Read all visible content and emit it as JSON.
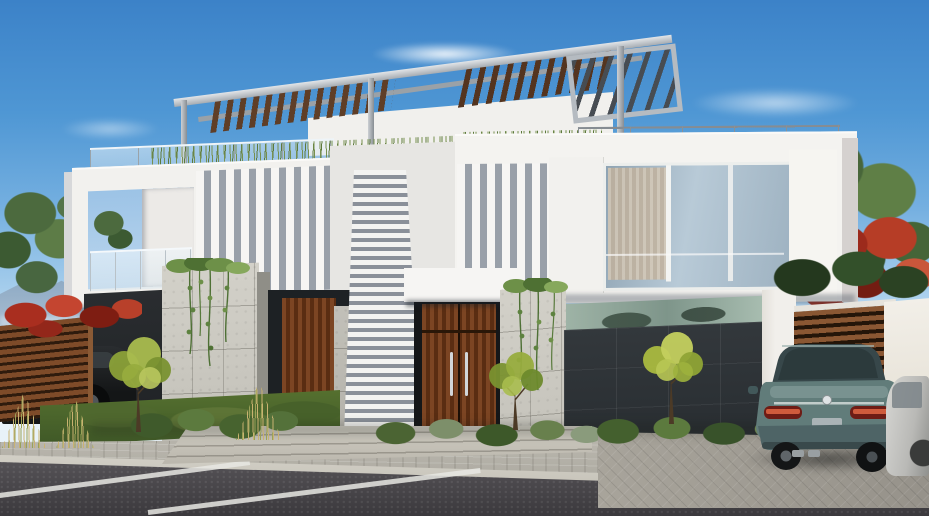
{
  "scene": {
    "type": "3d-architectural-exterior-render",
    "description": "Street-level daytime render of a modern two-storey white duplex villa with a rooftop steel-and-timber pergola, vertical shading fins, full-height louver screen, concrete and dark panelled ground-floor walls, timber entry doors, a timber slat gate with a teal sedan parked on the driveway, landscaped frontage and an asphalt street with white parking markings in the foreground.",
    "time_of_day": "day",
    "weather": "clear"
  },
  "palette": {
    "sky_top": "#3c82c8",
    "sky_horizon": "#e2eff8",
    "cloud": "#ffffff",
    "mountain": "#8ba6c0",
    "white_wall_sunlit": "#f6f5f2",
    "white_wall_shaded": "#d7d8da",
    "fin_gap_shadow": "#99a0a9",
    "concrete": "#cbc9c1",
    "dark_panel": "#2e3337",
    "timber_door": "#7c4523",
    "timber_slat_gap": "#241509",
    "pergola_steel": "#b5bbc1",
    "pergola_timber": "#5f3e27",
    "glass_window": "#9eb2c1",
    "curtain": "#d8c9b4",
    "glass_railing": "#dceaf3",
    "foliage_green": "#5d7c47",
    "foliage_yellow_green": "#a9bc4e",
    "flower_red": "#b23a24",
    "lawn": "#5d7436",
    "grass_tan": "#c9b271",
    "sidewalk_paver": "#b8b5ac",
    "driveway_paver": "#a5a198",
    "asphalt": "#4a484c",
    "road_marking": "#e8e7e3",
    "car_teal": "#617c7a",
    "car_glass": "#37474a",
    "taillight_red": "#cf5b3c",
    "car_dark": "#1d2022",
    "car_silver": "#cbcbc8"
  },
  "objects": {
    "sky": {
      "label": "Clear blue sky"
    },
    "mountains": {
      "label": "Distant hazy mountains"
    },
    "villa": {
      "label": "Modern white duplex villa"
    },
    "pergola": {
      "label": "Rooftop steel and timber pergola"
    },
    "roof_terrace": {
      "label": "Roof terrace with glass railing and grasses"
    },
    "balcony": {
      "label": "Recessed balcony with glass railing"
    },
    "fins_left": {
      "label": "Vertical shading fins, left house"
    },
    "fins_right": {
      "label": "Vertical shading fins, right house"
    },
    "louver_screen": {
      "label": "Full-height white louver screen"
    },
    "upper_window": {
      "label": "Floor-to-ceiling glazing with curtain"
    },
    "main_door": {
      "label": "Timber double entry door with steel handles"
    },
    "side_door": {
      "label": "Timber side entry door"
    },
    "concrete_walls": {
      "label": "Board-marked concrete walls with hanging vines"
    },
    "garage": {
      "label": "Dark panelled garage wall with clerestory glass"
    },
    "gate": {
      "label": "Horizontal timber slat gate"
    },
    "boundary_wall": {
      "label": "White boundary wall"
    },
    "fence": {
      "label": "Timber slat fence with red bougainvillea"
    },
    "teal_car": {
      "label": "Teal sedan parked on the driveway"
    },
    "dark_car": {
      "label": "Dark car parked behind the fence"
    },
    "silver_car": {
      "label": "Edge of a silver car at the right"
    },
    "landscaping": {
      "label": "Ornamental trees, shrubs and grasses"
    },
    "street": {
      "label": "Asphalt street with white parking markings"
    },
    "sidewalk": {
      "label": "Paved sidewalk and driveway aprons"
    }
  }
}
